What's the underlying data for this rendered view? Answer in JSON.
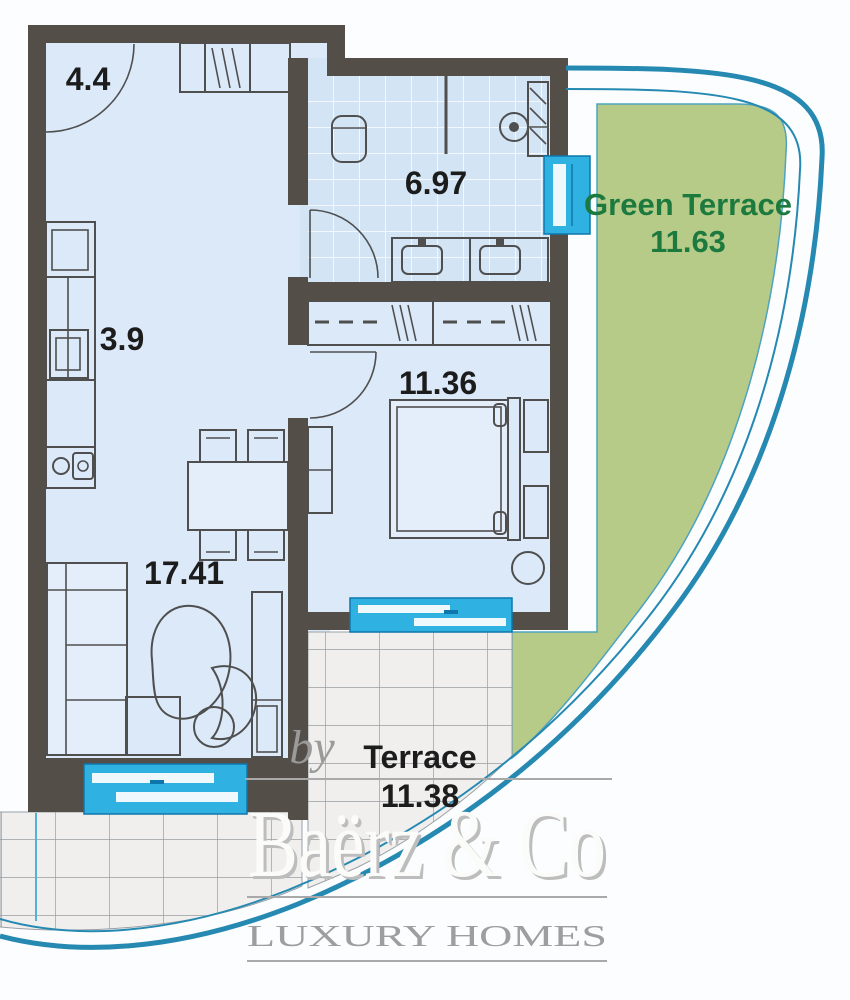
{
  "plan": {
    "rooms": {
      "hall": {
        "area": "4.4"
      },
      "bathroom": {
        "area": "6.97"
      },
      "kitchen": {
        "area": "3.9"
      },
      "bedroom": {
        "area": "11.36"
      },
      "living_room": {
        "area": "17.41"
      },
      "green_terrace": {
        "name": "Green Terrace",
        "area": "11.63"
      },
      "terrace": {
        "name": "Terrace",
        "area": "11.38"
      }
    },
    "colors": {
      "wall": "#544e49",
      "room_floor": "#dbe9f8",
      "bathroom_floor": "#d3e5f5",
      "window_cyan": "#2fb2e2",
      "green_terrace_fill": "#b6cb88",
      "green_label_text": "#1d7a3f",
      "boundary_curve": "#2589b1",
      "terrace_tile": "#f0efee",
      "label_text": "#1c1c1c"
    }
  },
  "branding": {
    "by_label": "by",
    "name": "Baërz & Co",
    "tagline": "LUXURY HOMES"
  }
}
